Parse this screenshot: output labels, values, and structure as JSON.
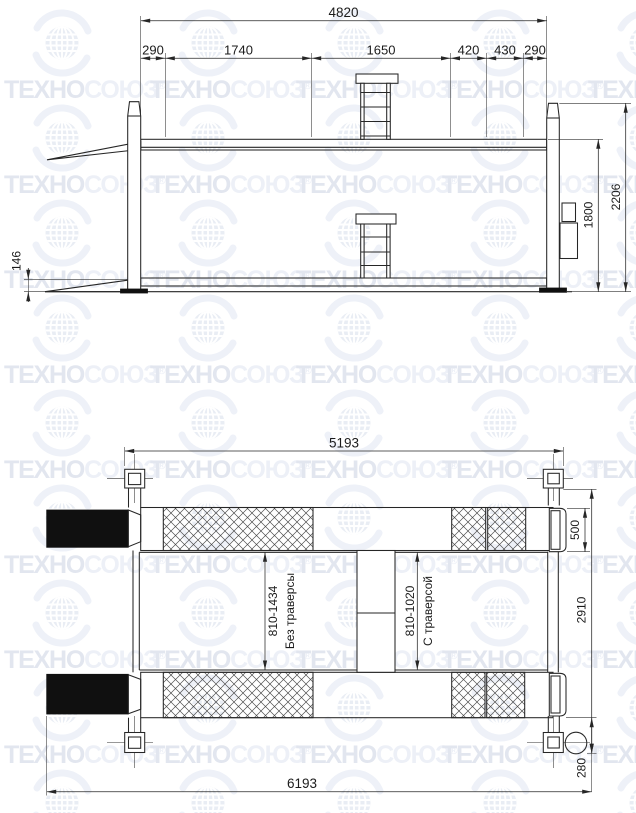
{
  "watermark": {
    "brand_bold": "ТЕХНО",
    "brand_light": "СОЮЗ",
    "reg": "®",
    "color": "#e2e6ef",
    "color_light": "#edf0f7"
  },
  "side_view": {
    "total_width": "4820",
    "segments": [
      "290",
      "1740",
      "1650",
      "420",
      "430",
      "290"
    ],
    "overall_height": "2206",
    "lift_height": "1800",
    "lowered_height": "146"
  },
  "plan_view": {
    "post_span": "5193",
    "overall_length": "6193",
    "overall_width": "2910",
    "runway_width": "500",
    "motor_offset": "280",
    "range_without_traverse": "810-1434",
    "label_without_traverse": "Без траверсы",
    "range_with_traverse": "810-1020",
    "label_with_traverse": "С траверсой"
  }
}
